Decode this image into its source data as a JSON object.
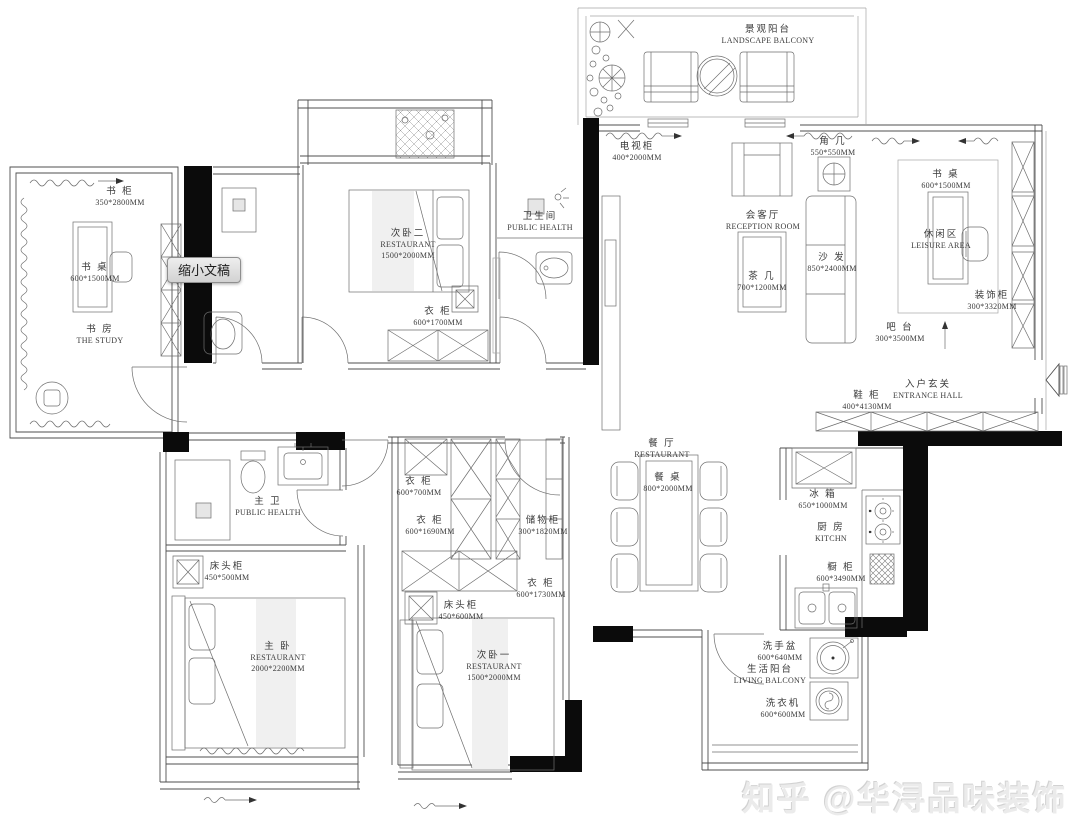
{
  "tooltip": {
    "label": "缩小文稿"
  },
  "watermark": {
    "text": "知乎 @华浔品味装饰"
  },
  "colors": {
    "wall": "#0b0b0b",
    "line": "#4f4f4f",
    "shade": "#f0f0f0"
  },
  "plan": {
    "labels": {
      "study_cabinet": {
        "cn": "书 柜",
        "dim": "350*2800MM"
      },
      "study_desk": {
        "cn": "书 桌",
        "dim": "600*1500MM"
      },
      "study_room": {
        "cn": "书 房",
        "en": "THE STUDY"
      },
      "bedroom2": {
        "cn": "次卧二",
        "en": "RESTAURANT",
        "dim": "1500*2000MM"
      },
      "wardrobe2": {
        "cn": "衣 柜",
        "dim": "600*1700MM"
      },
      "bath2": {
        "cn": "卫生间",
        "en": "PUBLIC HEALTH"
      },
      "balcony_ls": {
        "cn": "景观阳台",
        "en": "LANDSCAPE BALCONY"
      },
      "tv_cabinet": {
        "cn": "电视柜",
        "dim": "400*2000MM"
      },
      "corner_table": {
        "cn": "角 几",
        "dim": "550*550MM"
      },
      "reception": {
        "cn": "会客厅",
        "en": "RECEPTION ROOM"
      },
      "tea_table": {
        "cn": "茶 几",
        "dim": "700*1200MM"
      },
      "sofa": {
        "cn": "沙 发",
        "dim": "850*2400MM"
      },
      "leisure_desk": {
        "cn": "书 桌",
        "dim": "600*1500MM"
      },
      "leisure": {
        "cn": "休闲区",
        "en": "LEISURE AREA"
      },
      "deco_cabinet": {
        "cn": "装饰柜",
        "dim": "300*3320MM"
      },
      "bar": {
        "cn": "吧 台",
        "dim": "300*3500MM"
      },
      "entrance": {
        "cn": "入户玄关",
        "en": "ENTRANCE HALL"
      },
      "shoe_cabinet": {
        "cn": "鞋 柜",
        "dim": "400*4130MM"
      },
      "dining": {
        "cn": "餐 厅",
        "en": "RESTAURANT"
      },
      "dining_table": {
        "cn": "餐 桌",
        "dim": "800*2000MM"
      },
      "fridge": {
        "cn": "冰 箱",
        "dim": "650*1000MM"
      },
      "kitchen": {
        "cn": "厨 房",
        "en": "KITCHN"
      },
      "kitchen_cabinet": {
        "cn": "橱 柜",
        "dim": "600*3490MM"
      },
      "wash_basin": {
        "cn": "洗手盆",
        "dim": "600*640MM"
      },
      "living_balcony": {
        "cn": "生活阳台",
        "en": "LIVING BALCONY"
      },
      "washer": {
        "cn": "洗衣机",
        "dim": "600*600MM"
      },
      "master_bath": {
        "cn": "主 卫",
        "en": "PUBLIC HEALTH"
      },
      "bedside_master": {
        "cn": "床头柜",
        "dim": "450*500MM"
      },
      "master_bed": {
        "cn": "主 卧",
        "en": "RESTAURANT",
        "dim": "2000*2200MM"
      },
      "bedside_1": {
        "cn": "床头柜",
        "dim": "450*600MM"
      },
      "bedroom1": {
        "cn": "次卧一",
        "en": "RESTAURANT",
        "dim": "1500*2000MM"
      },
      "wardrobe_a": {
        "cn": "衣 柜",
        "dim": "600*700MM"
      },
      "wardrobe_b": {
        "cn": "衣 柜",
        "dim": "600*1690MM"
      },
      "storage_cabinet": {
        "cn": "储物柜",
        "dim": "300*1820MM"
      },
      "wardrobe_c": {
        "cn": "衣 柜",
        "dim": "600*1730MM"
      }
    }
  }
}
